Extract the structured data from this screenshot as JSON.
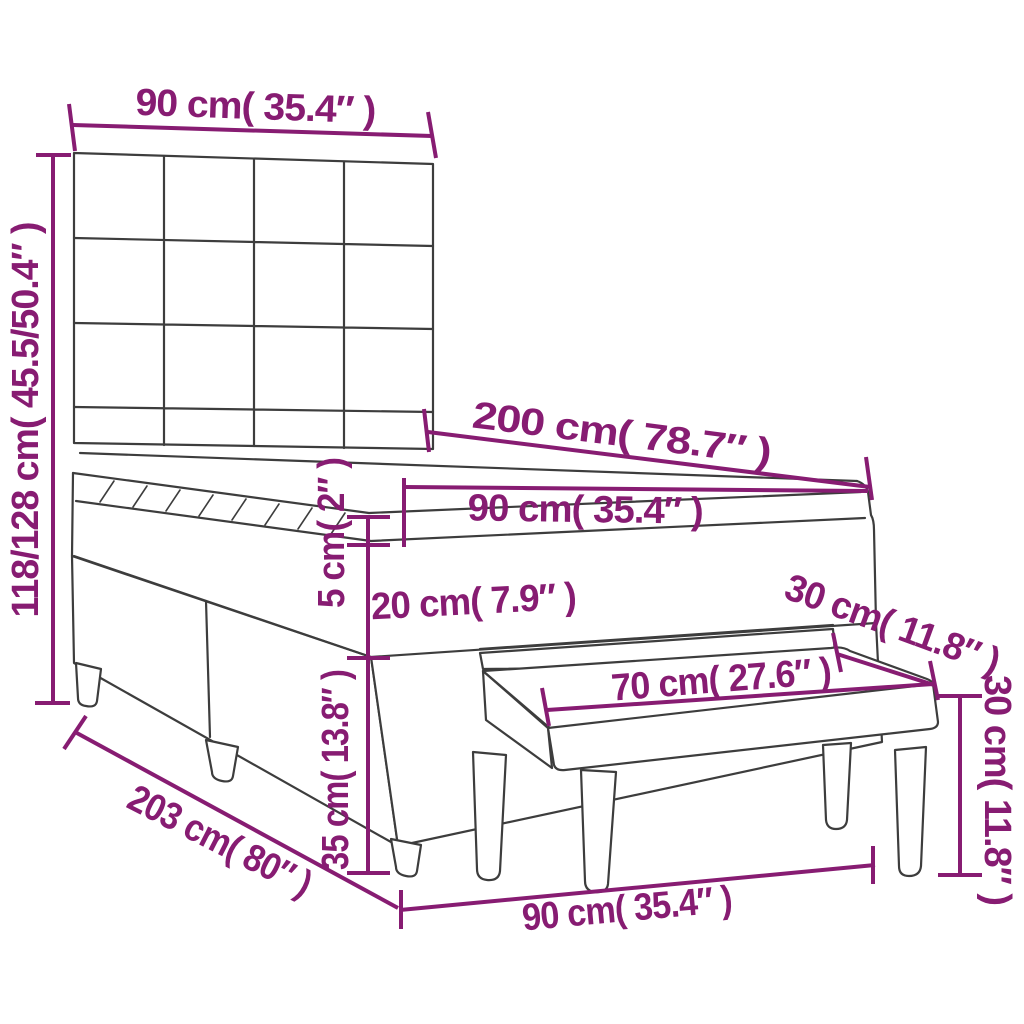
{
  "diagram": {
    "colors": {
      "dimension_color": "#871C72",
      "line_color": "#3D3D3D",
      "background": "#FFFFFF"
    },
    "labels": {
      "headboard_width": "90 cm( 35.4″ )",
      "bed_height": "118/128 cm( 45.5/50.4″ )",
      "mattress_length": "200 cm( 78.7″ )",
      "mattress_width": "90 cm( 35.4″ )",
      "topper_thickness": "5 cm( 2″ )",
      "mattress_thickness": "20 cm( 7.9″ )",
      "bench_depth": "30 cm( 11.8″ )",
      "bench_length": "70 cm( 27.6″ )",
      "bench_height": "30 cm( 11.8″ )",
      "base_height": "35 cm( 13.8″ )",
      "bed_length": "203 cm( 80″ )",
      "bed_width": "90 cm( 35.4″ )"
    }
  }
}
